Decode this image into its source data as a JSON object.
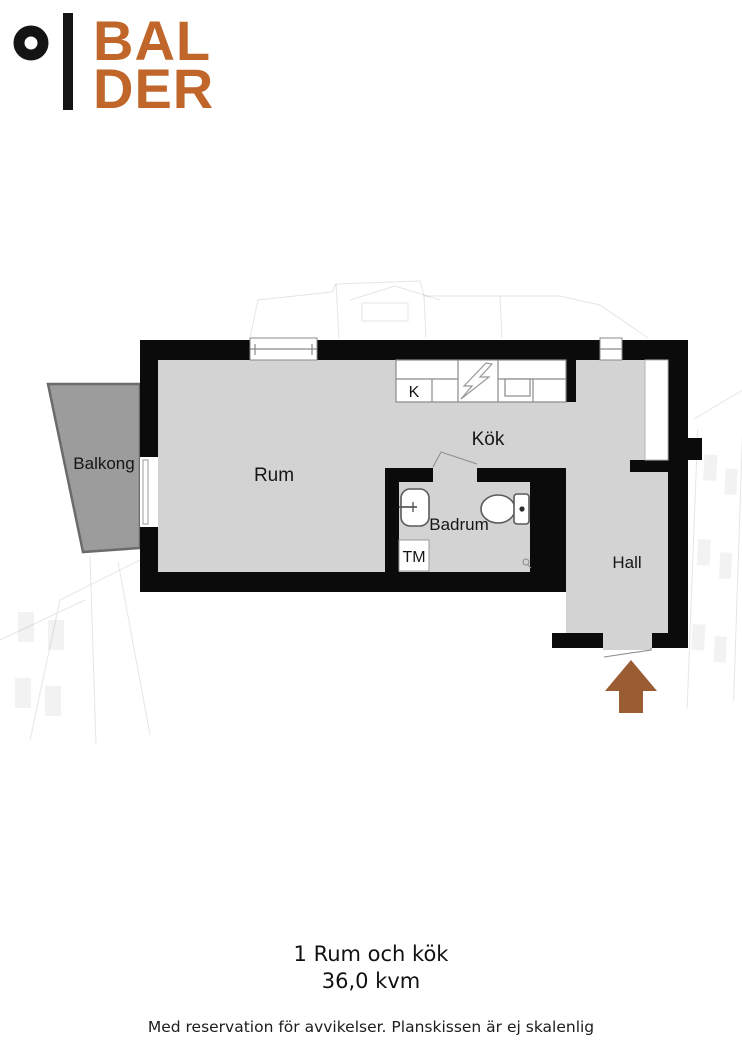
{
  "logo": {
    "line1": "BAL",
    "line2": "DER"
  },
  "labels": {
    "balkong": "Balkong",
    "rum": "Rum",
    "kok": "Kök",
    "badrum": "Badrum",
    "hall": "Hall",
    "tm": "TM",
    "kitchen_k": "K"
  },
  "summary": {
    "title": "1 Rum och kök",
    "area": "36,0 kvm"
  },
  "footer": {
    "disclaimer": "Med reservation för avvikelser. Planskissen är ej skalenlig"
  },
  "icons": {
    "logo_mark": "ring-and-bar",
    "entrance": "arrow-up",
    "stove": "lightning-zigzag",
    "sink_kitchen": "rect-basin",
    "sink_bath": "washbasin",
    "toilet": "toilet-with-tank",
    "washing_machine": "TM-box",
    "floor_drain": "small-drain"
  },
  "colors": {
    "logo_orange": "#C1662A",
    "arrow_brown": "#9A5C33",
    "floor_gray": "#D3D3D3",
    "balcony_gray": "#9C9C9C",
    "wall_black": "#0B0B0B"
  }
}
